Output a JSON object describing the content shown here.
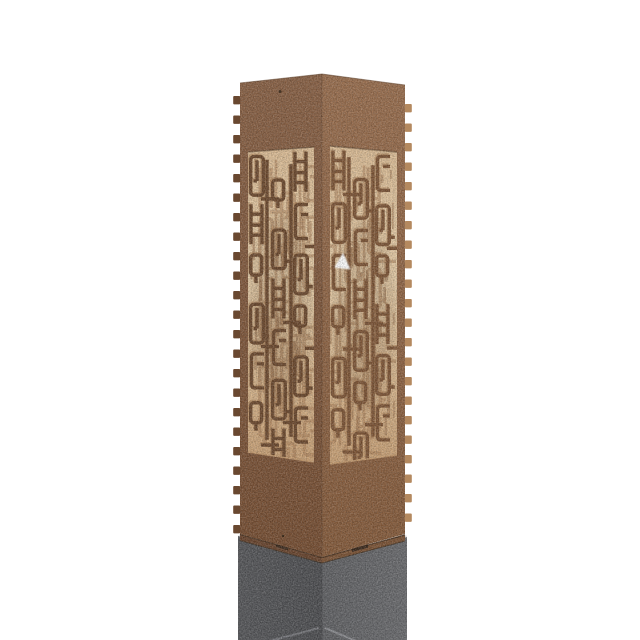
{
  "scene": {
    "background": "#ffffff",
    "description": "Product photo: rectangular corten-steel bollard light with laser-cut geometric maze pattern, warm light glowing through cutouts, mounted on a dark grey concrete anchor base"
  },
  "bollard": {
    "body": {
      "left_top": "#8b6347",
      "left_bottom": "#774f33",
      "right_top": "#9b7050",
      "right_bottom": "#865c3c",
      "edge_dark": "#5c3f2a",
      "lip_left": "#6b4730",
      "lip_right": "#7d5537",
      "notch": "#3c2b1e",
      "tab_left": "#694830",
      "tab_right": "#b4895f",
      "hole": "#3a2817"
    },
    "pattern": {
      "window_top": "#dcbd96",
      "window_mid": "#e9d0ab",
      "window_bottom": "#c9a176",
      "stroke_left": "#6d4a2f",
      "stroke_right": "#7e5637",
      "highlight": "#aa8058",
      "backface": "#a57b55",
      "streak": "#956e4b",
      "inner_shadow": "#5f4027",
      "frame_light": "#c79d72",
      "frame_dark": "#503a26"
    },
    "led": {
      "color": "#ffffff"
    },
    "base": {
      "left_outer": "#58595c",
      "left_corner": "#4e4f52",
      "right_corner": "#616265",
      "right_outer": "#6c6d70",
      "chamfer_line_left": "#7e7f84",
      "chamfer_line_right": "#94959a",
      "seam": "#43301f"
    }
  }
}
